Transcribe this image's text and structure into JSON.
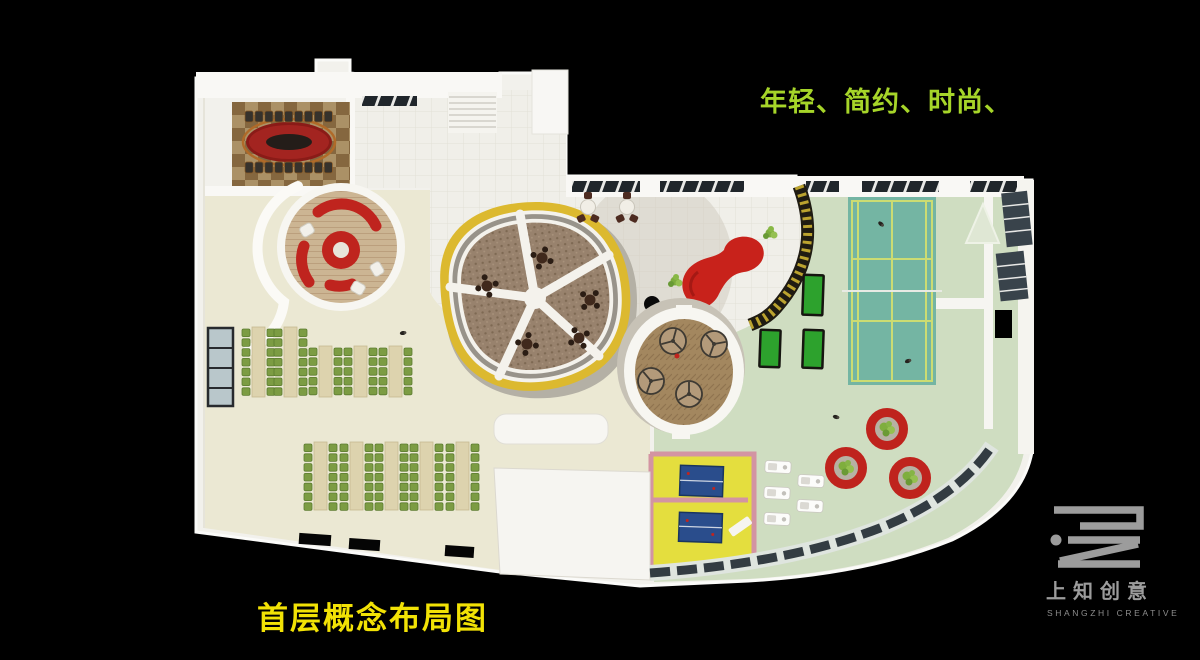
{
  "slide": {
    "background": "#000000",
    "captions": {
      "style_keywords": "年轻、简约、时尚、",
      "plan_title": "首层概念布局图"
    }
  },
  "branding": {
    "company_cn": "上知创意",
    "company_en": "SHANGZHI CREATIVE"
  },
  "palette": {
    "caption_green": "#a6d529",
    "caption_yellow": "#f2e205",
    "logo_gray": "#9c9c9c",
    "logo_gray_dim": "#8d8d8d",
    "building_white": "#f2f1ec",
    "floor_cream": "#ebe8d3",
    "floor_tile": "#f0efe9",
    "floor_green": "#cfddc1",
    "floor_brown": "#98826d",
    "accent_red": "#c0241e",
    "ring_yellow": "#dcb92f",
    "court_teal": "#74b5a3",
    "court_line_yellow": "#ccdc72",
    "chair_green": "#7c9c43",
    "table_beige": "#ddd3ae",
    "mat_green": "#2da22d",
    "pingpong_floor_yellow": "#e4de3e",
    "pingpong_wall_pink": "#d394a2",
    "pingpong_table_blue": "#2a4d8c"
  }
}
